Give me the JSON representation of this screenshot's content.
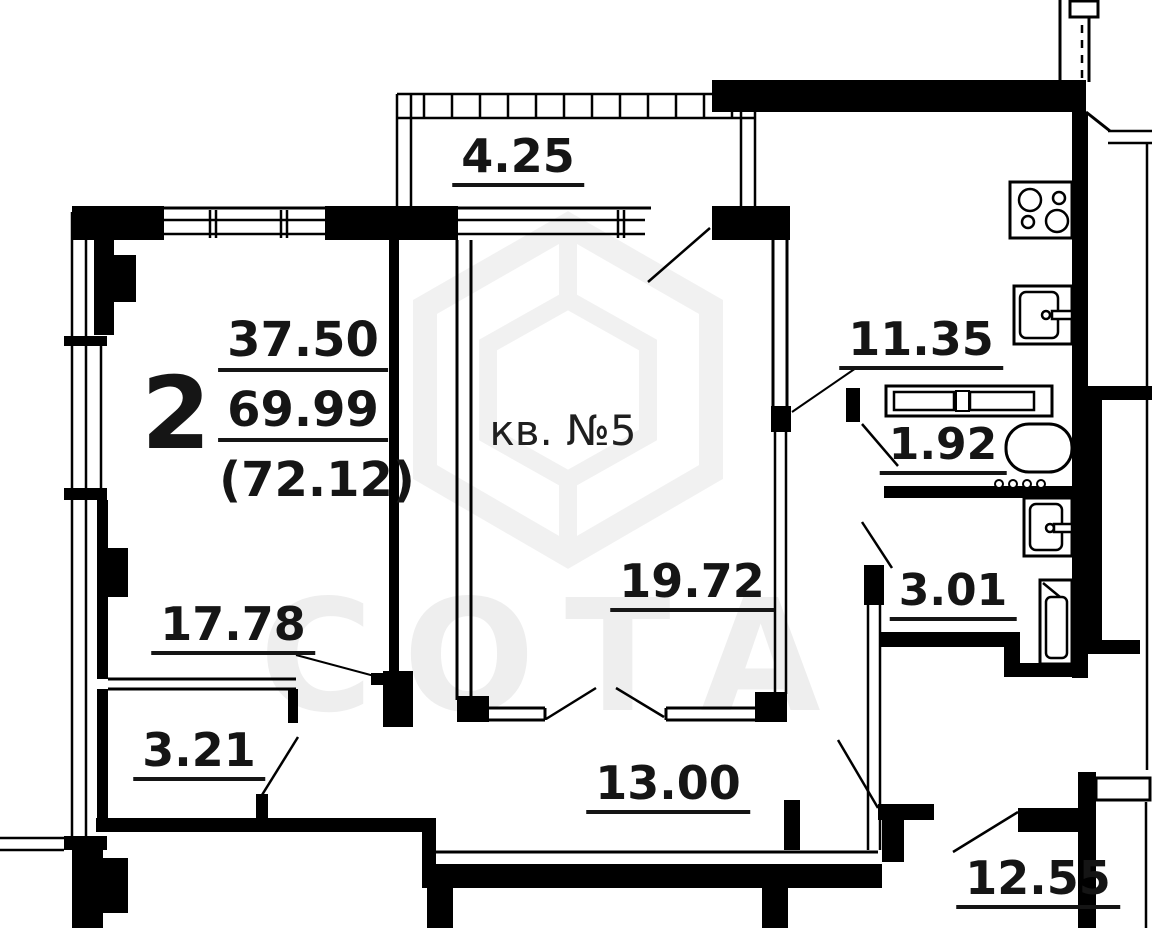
{
  "header": {
    "rooms_count": "2",
    "living_area": "37.50",
    "total_area": "69.99",
    "area_with_balcony": "(72.12)",
    "unit_label": "кв. №5"
  },
  "rooms": [
    {
      "name": "balcony",
      "area": "4.25"
    },
    {
      "name": "living-room",
      "area": "17.78"
    },
    {
      "name": "bedroom",
      "area": "19.72"
    },
    {
      "name": "kitchen",
      "area": "11.35"
    },
    {
      "name": "wc",
      "area": "1.92"
    },
    {
      "name": "bathroom",
      "area": "3.01"
    },
    {
      "name": "storage",
      "area": "3.21"
    },
    {
      "name": "hallway",
      "area": "13.00"
    },
    {
      "name": "adjacent-room",
      "area": "12.55"
    }
  ],
  "watermark": {
    "text": "СОТА"
  },
  "colors": {
    "line": "#000000",
    "label": "#151515",
    "watermark": "#ededed"
  }
}
